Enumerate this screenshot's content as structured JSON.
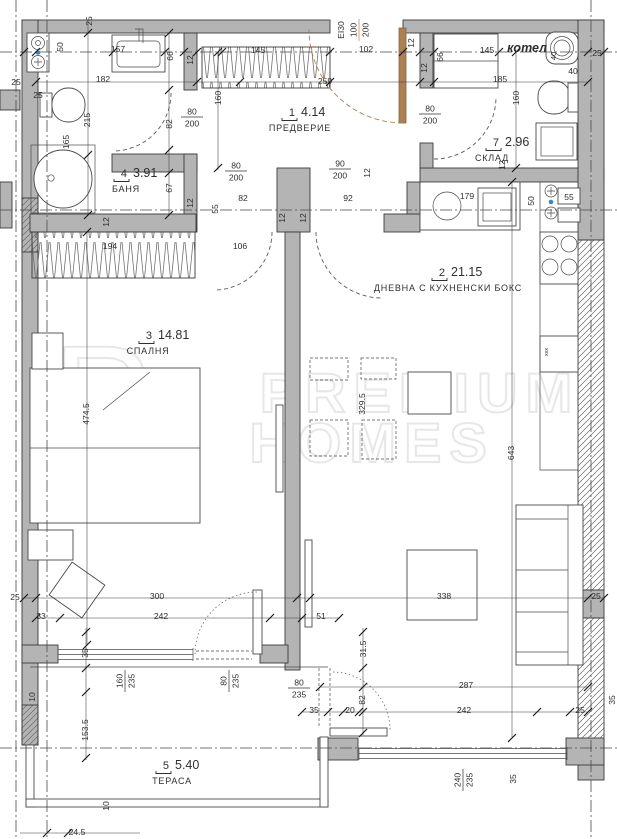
{
  "plan": {
    "title": "apartment-floor-plan",
    "boiler_label": "котел",
    "colors": {
      "wall": "#b4b4b4",
      "line": "#3a3a3a",
      "dim": "#2f2f2f",
      "accent": "#c0803f",
      "door_leaf": "#ad8054",
      "axis": "#4a4a4a",
      "watermark": "#e7e7e7",
      "dot": "#3f85c2"
    },
    "watermark": {
      "monogram_p": "P",
      "monogram_h": "H",
      "line1": "PREMIUM",
      "line2": "HOMES"
    },
    "kitchen": {
      "sink_label": "55"
    },
    "rooms": [
      {
        "number": "1",
        "area": "4.14",
        "name": "ПРЕДВЕРИЕ",
        "x": 295,
        "y": 116,
        "cx": 300
      },
      {
        "number": "2",
        "area": "21.15",
        "name": "ДНЕВНА С КУХНЕНСКИ БОКС",
        "x": 445,
        "y": 276,
        "cx": 448
      },
      {
        "number": "3",
        "area": "14.81",
        "name": "СПАЛНЯ",
        "x": 152,
        "y": 339,
        "cx": 148
      },
      {
        "number": "4",
        "area": "3.91",
        "name": "БАНЯ",
        "x": 127,
        "y": 177,
        "cx": 126
      },
      {
        "number": "5",
        "area": "5.40",
        "name": "ТЕРАСА",
        "x": 169,
        "y": 769,
        "cx": 172
      },
      {
        "number": "7",
        "area": "2.96",
        "name": "СКЛАД",
        "x": 499,
        "y": 146,
        "cx": 492
      }
    ],
    "labels": [
      {
        "t": "25",
        "x": 89,
        "y": 21,
        "r": -90
      },
      {
        "t": "157",
        "x": 118,
        "y": 49
      },
      {
        "t": "50",
        "x": 60,
        "y": 47,
        "r": -90
      },
      {
        "t": "66",
        "x": 170,
        "y": 56,
        "r": -90
      },
      {
        "t": "12",
        "x": 190,
        "y": 60,
        "r": -90
      },
      {
        "t": "25",
        "x": 16,
        "y": 82
      },
      {
        "t": "182",
        "x": 103,
        "y": 79
      },
      {
        "t": "259",
        "x": 325,
        "y": 81
      },
      {
        "t": "185",
        "x": 500,
        "y": 79
      },
      {
        "t": "102",
        "x": 366,
        "y": 49
      },
      {
        "t": "145",
        "x": 258,
        "y": 50
      },
      {
        "t": "145",
        "x": 487,
        "y": 50
      },
      {
        "t": "12",
        "x": 411,
        "y": 43,
        "r": -90
      },
      {
        "t": "12",
        "x": 424,
        "y": 68,
        "r": -90
      },
      {
        "t": "66",
        "x": 440,
        "y": 57,
        "r": -90
      },
      {
        "t": "40",
        "x": 553,
        "y": 56,
        "r": -90,
        "size": 7.5
      },
      {
        "t": "40",
        "x": 573,
        "y": 71
      },
      {
        "t": "25",
        "x": 597,
        "y": 53
      },
      {
        "t": "25",
        "x": 38,
        "y": 95
      },
      {
        "t": "215",
        "x": 87,
        "y": 120,
        "r": -90
      },
      {
        "t": "165",
        "x": 66,
        "y": 142,
        "r": -90
      },
      {
        "t": "82",
        "x": 169,
        "y": 124,
        "r": -90
      },
      {
        "t": "160",
        "x": 218,
        "y": 98,
        "r": -90
      },
      {
        "t": "160",
        "x": 516,
        "y": 98,
        "r": -90
      },
      {
        "t": "67",
        "x": 169,
        "y": 188,
        "r": -90
      },
      {
        "t": "12",
        "x": 190,
        "y": 203,
        "r": -90
      },
      {
        "t": "55",
        "x": 215,
        "y": 209,
        "r": -90
      },
      {
        "t": "82",
        "x": 243,
        "y": 198
      },
      {
        "t": "92",
        "x": 348,
        "y": 198
      },
      {
        "t": "12",
        "x": 367,
        "y": 173,
        "r": -90
      },
      {
        "t": "12",
        "x": 282,
        "y": 218,
        "r": -90
      },
      {
        "t": "12",
        "x": 303,
        "y": 218,
        "r": -90
      },
      {
        "t": "12",
        "x": 106,
        "y": 222,
        "r": -90
      },
      {
        "t": "12",
        "x": 502,
        "y": 165,
        "r": -90
      },
      {
        "t": "179",
        "x": 467,
        "y": 196
      },
      {
        "t": "50",
        "x": 531,
        "y": 201,
        "r": -90
      },
      {
        "t": "194",
        "x": 110,
        "y": 246
      },
      {
        "t": "106",
        "x": 240,
        "y": 246
      },
      {
        "t": "474.5",
        "x": 86,
        "y": 414,
        "r": -90
      },
      {
        "t": "643",
        "x": 511,
        "y": 453,
        "r": -90
      },
      {
        "t": "329.5",
        "x": 362,
        "y": 404,
        "r": -90
      },
      {
        "t": "300",
        "x": 157,
        "y": 596
      },
      {
        "t": "338",
        "x": 444,
        "y": 596
      },
      {
        "t": "25",
        "x": 596,
        "y": 596
      },
      {
        "t": "25",
        "x": 15,
        "y": 597
      },
      {
        "t": "242",
        "x": 161,
        "y": 616
      },
      {
        "t": "33",
        "x": 41,
        "y": 616
      },
      {
        "t": "51",
        "x": 321,
        "y": 616
      },
      {
        "t": "35",
        "x": 85,
        "y": 653,
        "r": -90
      },
      {
        "t": "31.5",
        "x": 363,
        "y": 649,
        "r": -90
      },
      {
        "t": "82",
        "x": 362,
        "y": 700,
        "r": -90
      },
      {
        "t": "287",
        "x": 466,
        "y": 685
      },
      {
        "t": "242",
        "x": 464,
        "y": 710
      },
      {
        "t": "25",
        "x": 580,
        "y": 710
      },
      {
        "t": "35",
        "x": 314,
        "y": 710
      },
      {
        "t": "20",
        "x": 350,
        "y": 710
      },
      {
        "t": "153.5",
        "x": 85,
        "y": 730,
        "r": -90
      },
      {
        "t": "10",
        "x": 32,
        "y": 697,
        "r": -90
      },
      {
        "t": "10",
        "x": 106,
        "y": 806,
        "r": -90
      },
      {
        "t": "24.5",
        "x": 77,
        "y": 832
      },
      {
        "t": "35",
        "x": 513,
        "y": 779,
        "r": -90
      },
      {
        "t": "35",
        "x": 612,
        "y": 700,
        "r": -90
      },
      {
        "t": "EI30",
        "x": 341,
        "y": 30,
        "r": -90,
        "color": "accent"
      },
      {
        "t": "xxx",
        "x": 545,
        "y": 352,
        "r": -90,
        "size": 5.5
      }
    ],
    "fractions": [
      {
        "top": "80",
        "bottom": "200",
        "x": 192,
        "y": 117
      },
      {
        "top": "80",
        "bottom": "200",
        "x": 430,
        "y": 114
      },
      {
        "top": "80",
        "bottom": "200",
        "x": 236,
        "y": 171
      },
      {
        "top": "90",
        "bottom": "200",
        "x": 340,
        "y": 169
      },
      {
        "top": "160",
        "bottom": "235",
        "x": 125,
        "y": 681,
        "r": -90
      },
      {
        "top": "80",
        "bottom": "235",
        "x": 229,
        "y": 681,
        "r": -90
      },
      {
        "top": "80",
        "bottom": "235",
        "x": 299,
        "y": 688
      },
      {
        "top": "240",
        "bottom": "235",
        "x": 463,
        "y": 780,
        "r": -90
      },
      {
        "top": "100",
        "bottom": "200",
        "x": 359,
        "y": 30,
        "r": -90,
        "color": "accent"
      }
    ]
  }
}
